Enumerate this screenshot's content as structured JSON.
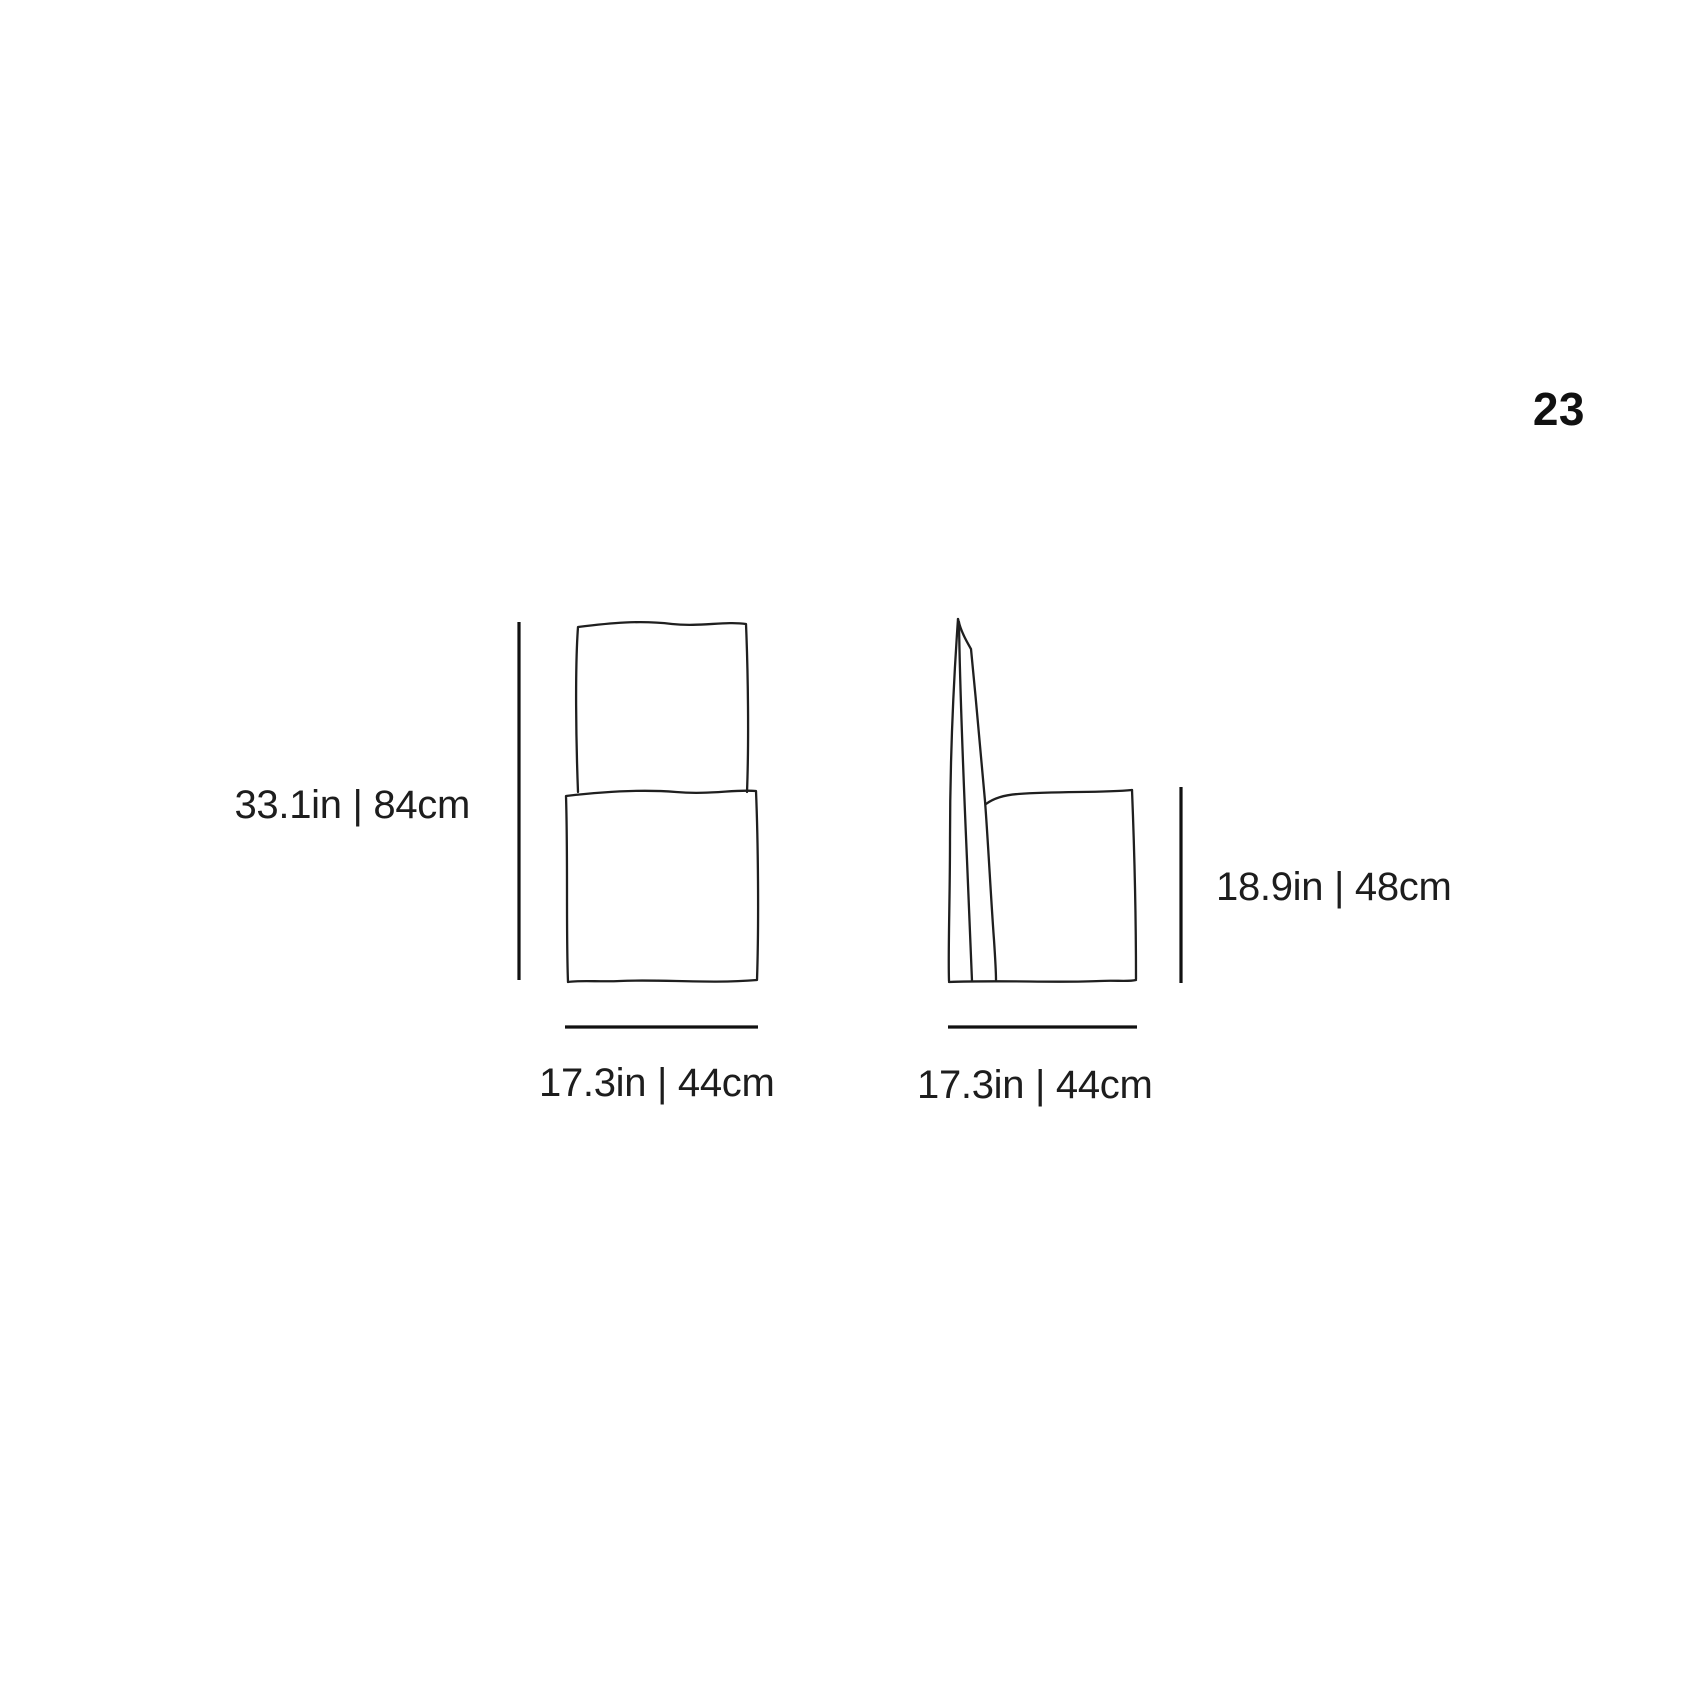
{
  "page": {
    "number": "23"
  },
  "colors": {
    "background": "#ffffff",
    "ink": "#1d1d1d",
    "dimension_line": "#111111"
  },
  "diagram": {
    "front_view": {
      "view": "chair-front-elevation",
      "height_label": "33.1in | 84cm",
      "width_label": "17.3in | 44cm"
    },
    "side_view": {
      "view": "chair-side-elevation",
      "seat_height_label": "18.9in | 48cm",
      "depth_label": "17.3in | 44cm"
    }
  }
}
